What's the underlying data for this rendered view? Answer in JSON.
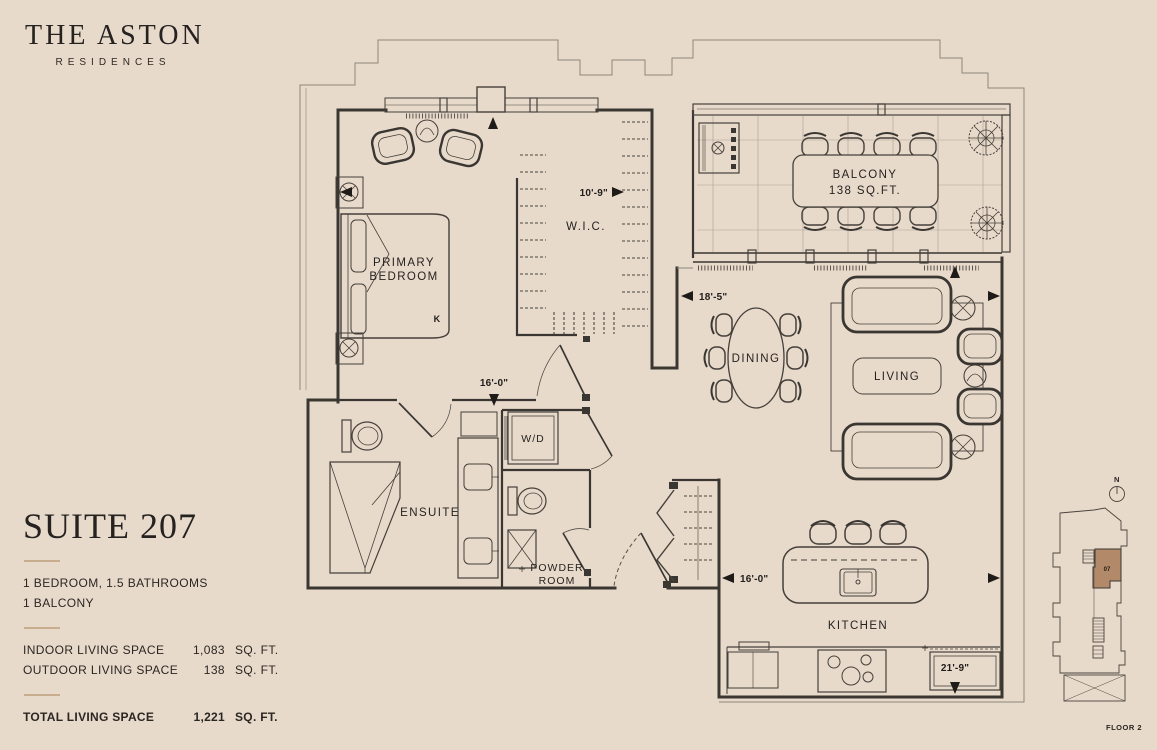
{
  "brand": {
    "name": "THE ASTON",
    "tagline": "RESIDENCES"
  },
  "suite": {
    "title": "SUITE 207",
    "features": [
      "1 BEDROOM, 1.5 BATHROOMS",
      "1 BALCONY"
    ],
    "specs": [
      {
        "label": "INDOOR LIVING SPACE",
        "value": "1,083",
        "unit": "SQ. FT."
      },
      {
        "label": "OUTDOOR LIVING SPACE",
        "value": "138",
        "unit": "SQ. FT."
      }
    ],
    "total": {
      "label": "TOTAL LIVING SPACE",
      "value": "1,221",
      "unit": "SQ. FT."
    }
  },
  "plan": {
    "rooms": {
      "primary_bedroom": {
        "line1": "PRIMARY",
        "line2": "BEDROOM"
      },
      "wic": "W.I.C.",
      "balcony": {
        "line1": "BALCONY",
        "line2": "138 SQ.FT."
      },
      "dining": "DINING",
      "living": "LIVING",
      "ensuite": "ENSUITE",
      "wd": "W/D",
      "powder": {
        "line1": "POWDER",
        "line2": "ROOM"
      },
      "kitchen": "KITCHEN"
    },
    "bed_label": "K",
    "dimensions": {
      "bedroom_width": "10'-9\"",
      "bedroom_depth": "16'-0\"",
      "living_width": "18'-5\"",
      "kitchen_width": "16'-0\"",
      "great_room_depth": "21'-9\""
    }
  },
  "keyplan": {
    "north": "N",
    "unit": "07",
    "floor": "FLOOR 2"
  },
  "colors": {
    "background": "#e8dacb",
    "ink": "#3a3632",
    "divider": "#c9ad8f",
    "keyplan_unit": "#b28a6a"
  }
}
